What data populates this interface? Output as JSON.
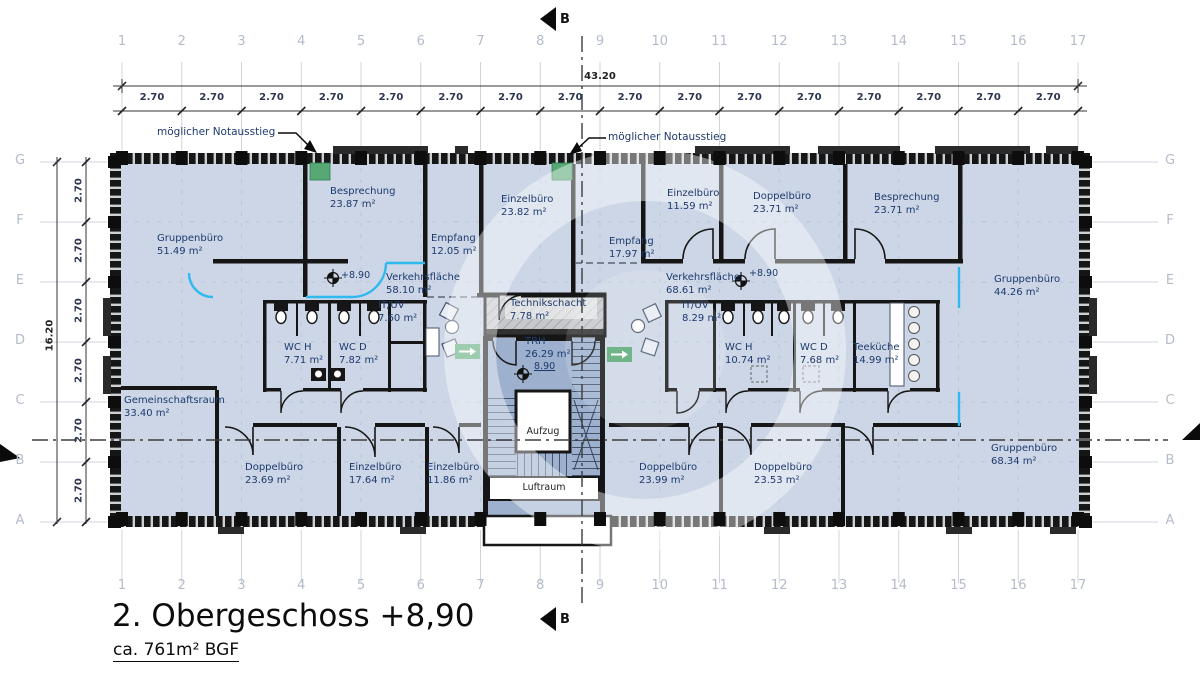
{
  "title": "2. Obergeschoss +8,90",
  "subtitle": "ca. 761m² BGF",
  "section_marker": {
    "top": "B",
    "bottom": "B"
  },
  "grid": {
    "columns": [
      "1",
      "2",
      "3",
      "4",
      "5",
      "6",
      "7",
      "8",
      "9",
      "10",
      "11",
      "12",
      "13",
      "14",
      "15",
      "16",
      "17"
    ],
    "rows": [
      "G",
      "F",
      "E",
      "D",
      "C",
      "B",
      "A"
    ]
  },
  "dimensions": {
    "bay": "2.70",
    "total_width": "43.20",
    "total_height": "16.20"
  },
  "annotations": {
    "exit_left": "möglicher Notausstieg",
    "exit_right": "möglicher Notausstieg"
  },
  "core": {
    "aufzug": "Aufzug",
    "luftraum": "Luftraum"
  },
  "level_markers": [
    {
      "label": "+8.90",
      "x": 341,
      "y": 270,
      "sx": 333,
      "sy": 278,
      "underline": false
    },
    {
      "label": "+8.90",
      "x": 749,
      "y": 268,
      "sx": 741,
      "sy": 281,
      "underline": false
    },
    {
      "label": "8.90",
      "x": 534,
      "y": 361,
      "sx": 523,
      "sy": 374,
      "underline": true
    }
  ],
  "rooms": [
    {
      "name": "Gruppenbüro",
      "area": "51.49 m²",
      "x": 157,
      "y": 233
    },
    {
      "name": "Besprechung",
      "area": "23.87 m²",
      "x": 330,
      "y": 186
    },
    {
      "name": "Empfang",
      "area": "12.05 m²",
      "x": 431,
      "y": 233
    },
    {
      "name": "Einzelbüro",
      "area": "23.82 m²",
      "x": 501,
      "y": 194
    },
    {
      "name": "Empfang",
      "area": "17.97 m²",
      "x": 609,
      "y": 236
    },
    {
      "name": "Einzelbüro",
      "area": "11.59 m²",
      "x": 667,
      "y": 188
    },
    {
      "name": "Doppelbüro",
      "area": "23.71 m²",
      "x": 753,
      "y": 191
    },
    {
      "name": "Besprechung",
      "area": "23.71 m²",
      "x": 874,
      "y": 192
    },
    {
      "name": "Gruppenbüro",
      "area": "44.26 m²",
      "x": 994,
      "y": 274
    },
    {
      "name": "Verkehrsfläche",
      "area": "58.10 m²",
      "x": 386,
      "y": 272
    },
    {
      "name": "Verkehrsfläche",
      "area": "68.61 m²",
      "x": 666,
      "y": 272
    },
    {
      "name": "IT/UV",
      "area": "7.60 m²",
      "x": 378,
      "y": 300
    },
    {
      "name": "IT/UV",
      "area": "8.29 m²",
      "x": 682,
      "y": 300
    },
    {
      "name": "WC H",
      "area": "7.71 m²",
      "x": 284,
      "y": 342
    },
    {
      "name": "WC D",
      "area": "7.82 m²",
      "x": 339,
      "y": 342
    },
    {
      "name": "WC H",
      "area": "10.74 m²",
      "x": 725,
      "y": 342
    },
    {
      "name": "WC D",
      "area": "7.68 m²",
      "x": 800,
      "y": 342
    },
    {
      "name": "Teeküche",
      "area": "14.99 m²",
      "x": 853,
      "y": 342
    },
    {
      "name": "Technikschacht",
      "area": "7.78 m²",
      "x": 510,
      "y": 298
    },
    {
      "name": "TRH",
      "area": "26.29 m²",
      "x": 525,
      "y": 336
    },
    {
      "name": "Gemeinschaftsraum",
      "area": "33.40 m²",
      "x": 124,
      "y": 395
    },
    {
      "name": "Doppelbüro",
      "area": "23.69 m²",
      "x": 245,
      "y": 462
    },
    {
      "name": "Einzelbüro",
      "area": "17.64 m²",
      "x": 349,
      "y": 462
    },
    {
      "name": "Einzelbüro",
      "area": "11.86 m²",
      "x": 427,
      "y": 462
    },
    {
      "name": "Doppelbüro",
      "area": "23.99 m²",
      "x": 639,
      "y": 462
    },
    {
      "name": "Doppelbüro",
      "area": "23.53 m²",
      "x": 754,
      "y": 462
    },
    {
      "name": "Gruppenbüro",
      "area": "68.34 m²",
      "x": 991,
      "y": 443
    }
  ],
  "colors": {
    "room_fill": "#ccd6e6",
    "stair_fill": "#9db1cf",
    "wall": "#161616",
    "glass_accent": "#2fb9ee",
    "exit_green": "#58a876",
    "label_navy": "#1d3a6d",
    "grid_text": "#b4bcc9",
    "tech_gray": "#c6c8cc"
  }
}
